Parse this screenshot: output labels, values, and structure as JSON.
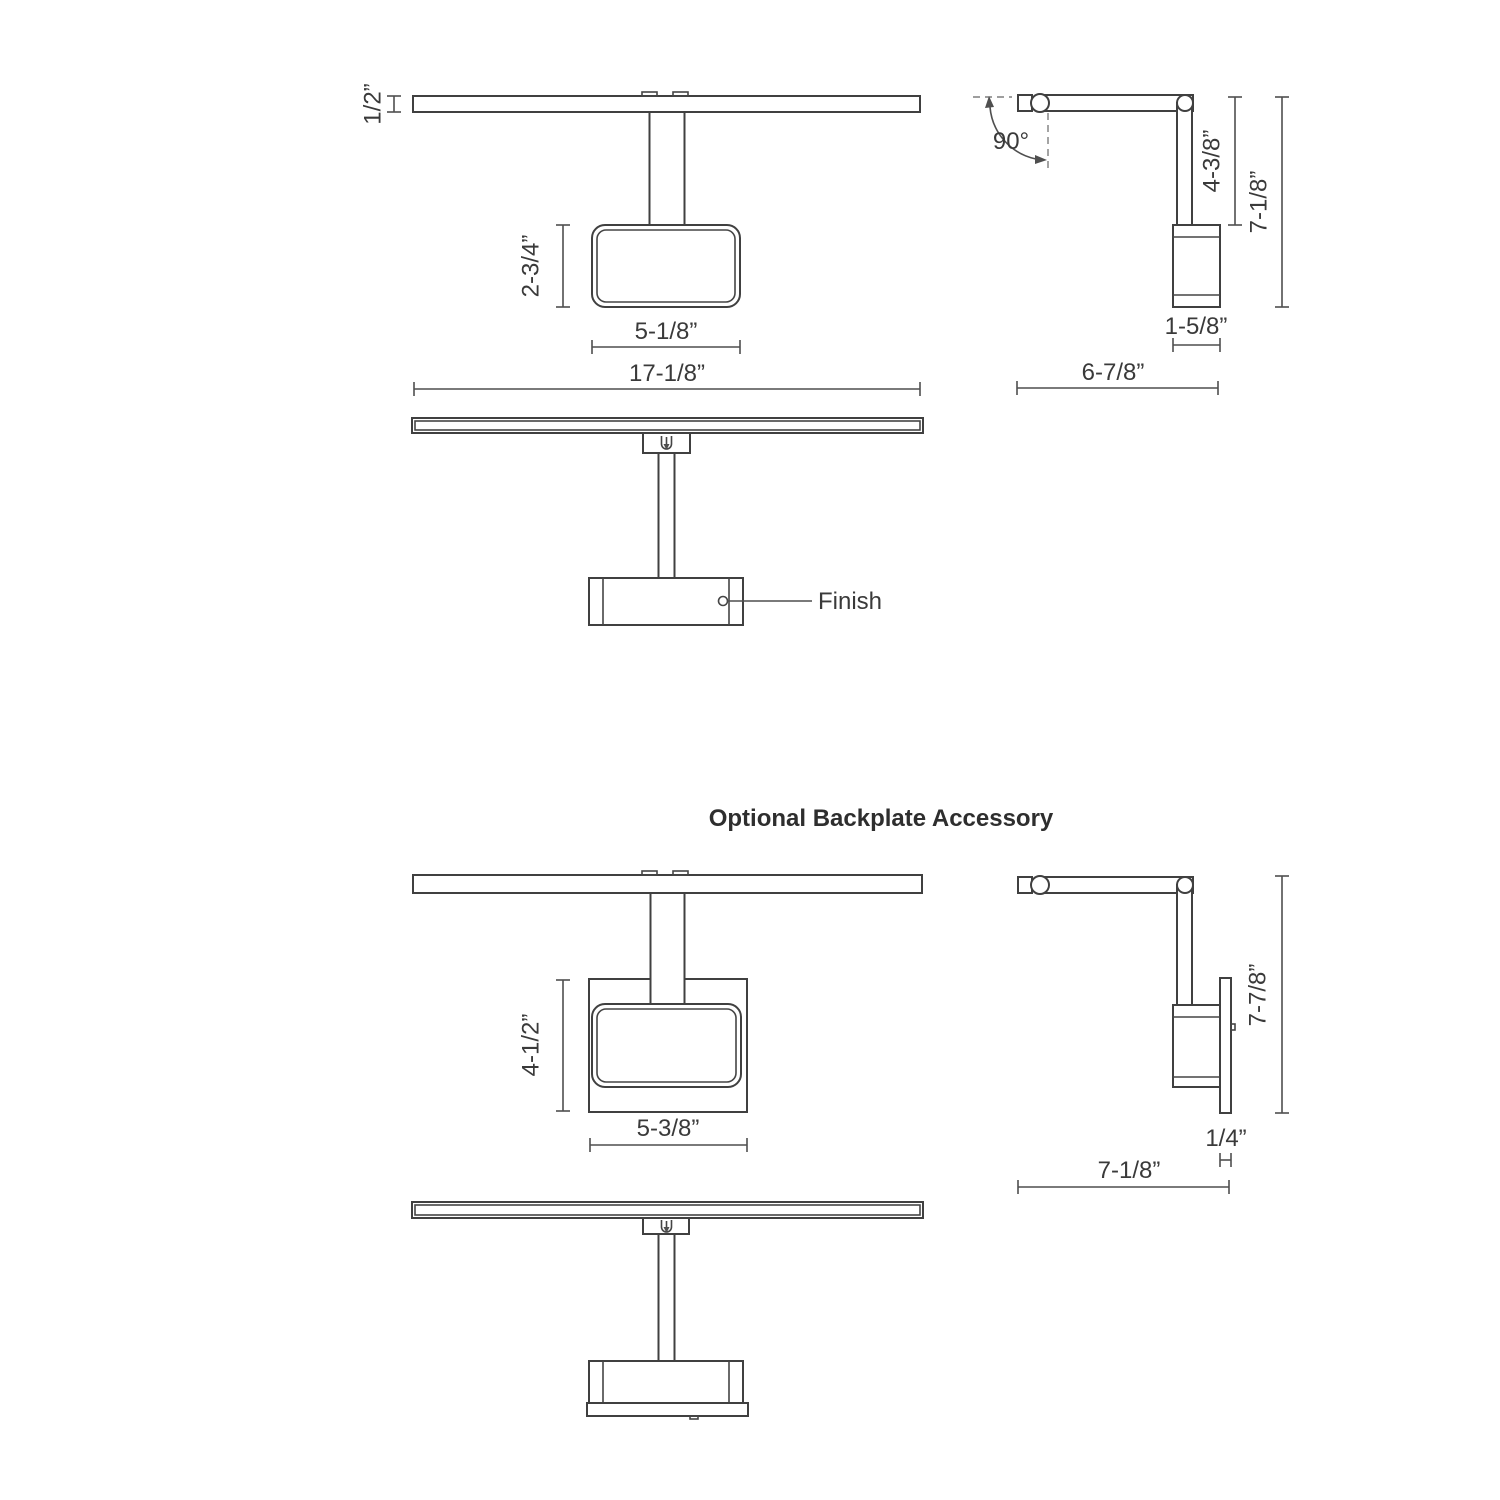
{
  "meta": {
    "background_color": "#ffffff",
    "line_color": "#404040",
    "dimension_color": "#4f4f4f",
    "text_color": "#3a3a3a"
  },
  "section_title": "Optional Backplate Accessory",
  "standard_fixture": {
    "front_view": {
      "bar_thickness": "1/2”",
      "head_height": "2-3/4”",
      "head_width": "5-1/8”",
      "overall_width": "17-1/8”"
    },
    "side_view": {
      "swivel_angle": "90°",
      "arm_drop": "4-3/8”",
      "overall_height": "7-1/8”",
      "head_depth": "1-5/8”",
      "overall_depth": "6-7/8”"
    },
    "bottom_view": {
      "finish_label": "Finish"
    }
  },
  "backplate_fixture": {
    "front_view": {
      "backplate_height": "4-1/2”",
      "backplate_width": "5-3/8”"
    },
    "side_view": {
      "overall_height": "7-7/8”",
      "backplate_thickness": "1/4”",
      "overall_depth": "7-1/8”"
    }
  }
}
